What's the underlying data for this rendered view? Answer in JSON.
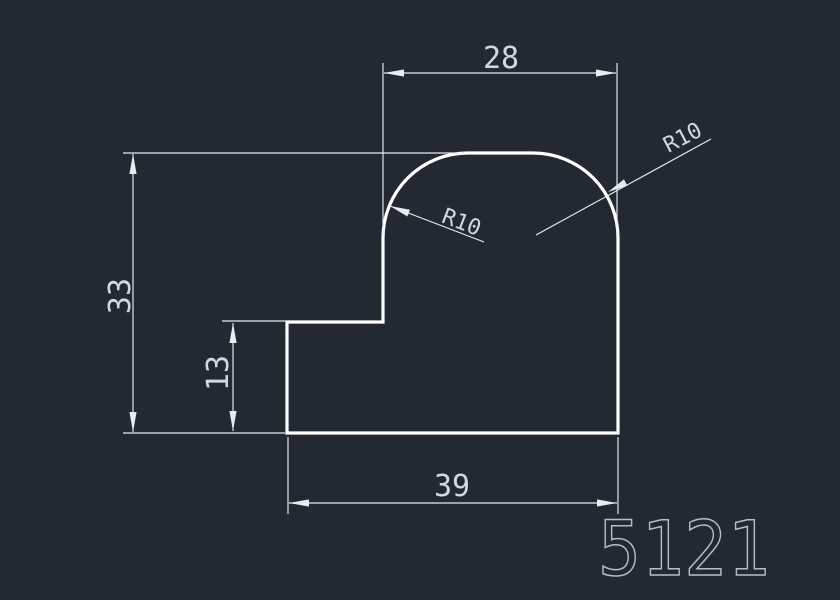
{
  "drawing": {
    "background_color": "#232932",
    "outline_color": "#ffffff",
    "dimension_color": "#e8ebf0",
    "text_color": "#d3d8df",
    "part_number_color": "#b7bdc6",
    "dimensions": {
      "top_width": "28",
      "overall_height": "33",
      "step_height": "13",
      "bottom_width": "39",
      "left_corner_radius": "R10",
      "right_corner_radius": "R10"
    },
    "part_number": "5121"
  }
}
